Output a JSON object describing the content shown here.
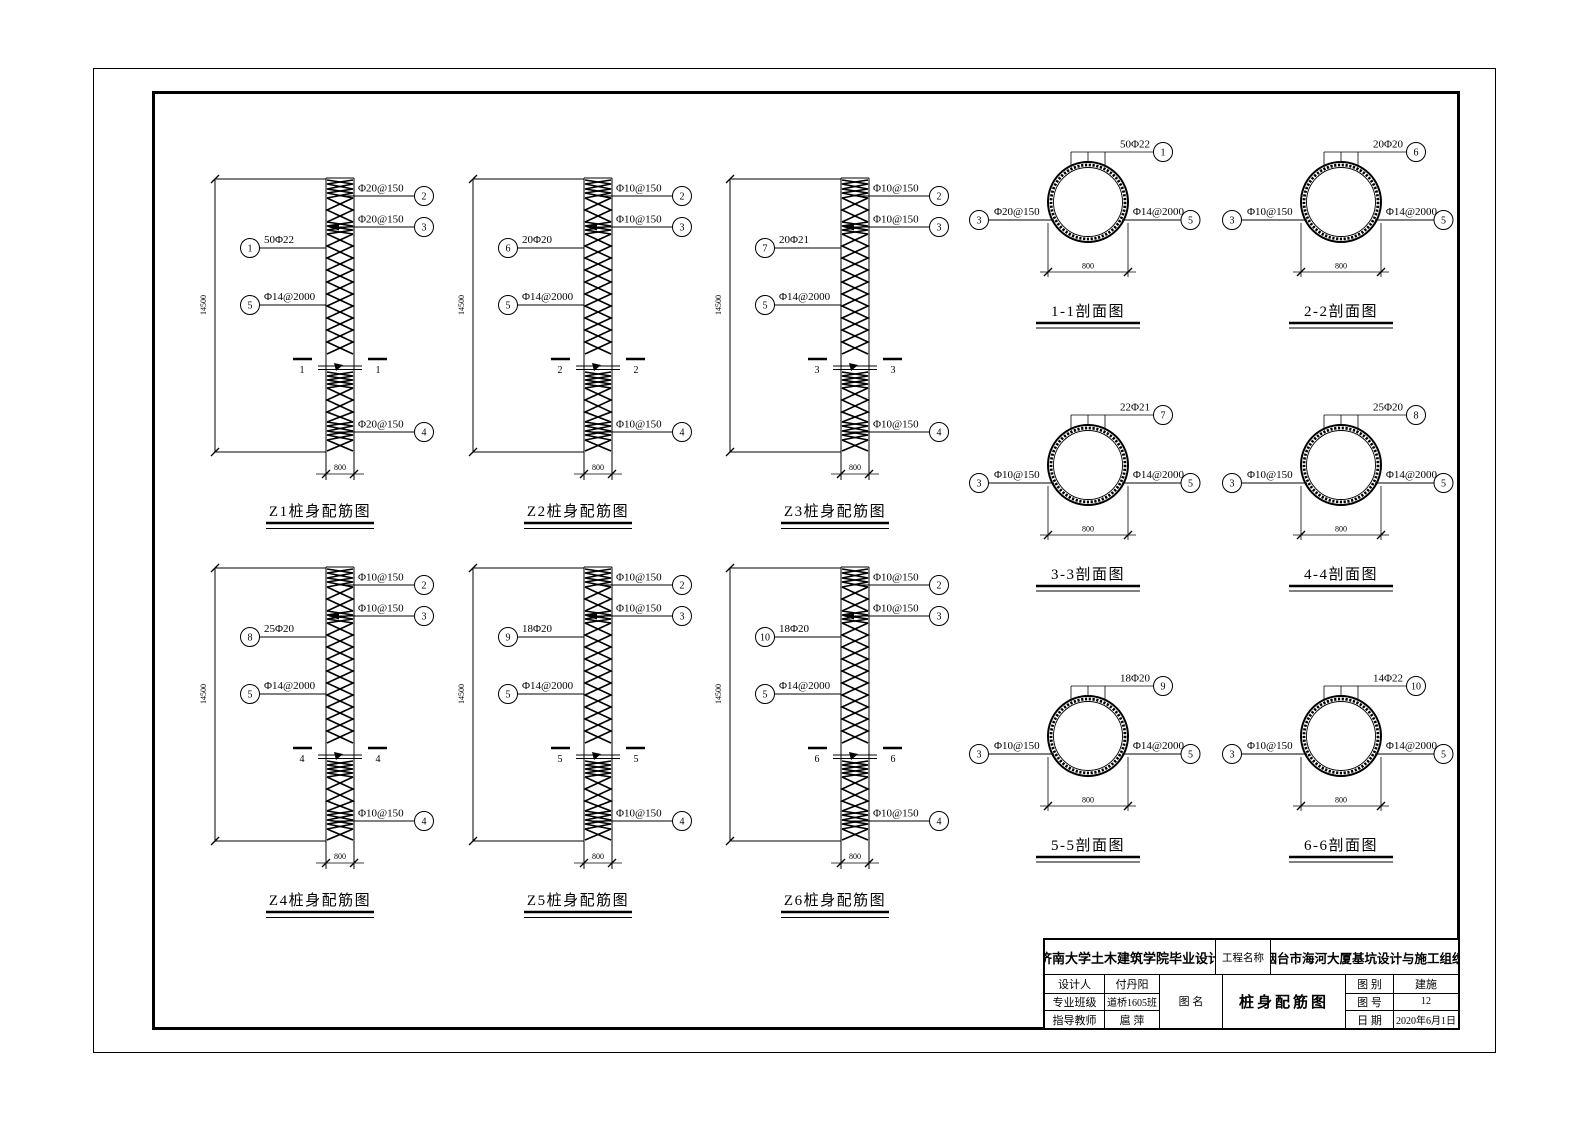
{
  "elevations": [
    {
      "id": "Z1",
      "title": "Z1桩身配筋图",
      "dim_height": "14500",
      "dim_width": "800",
      "cut_label": "1",
      "leaders": {
        "top1": {
          "ref": "2",
          "label": "Φ20@150"
        },
        "top2": {
          "ref": "3",
          "label": "Φ20@150"
        },
        "main": {
          "ref": "1",
          "label": "50Φ22"
        },
        "tie": {
          "ref": "5",
          "label": "Φ14@2000"
        },
        "bottom": {
          "ref": "4",
          "label": "Φ20@150"
        }
      }
    },
    {
      "id": "Z2",
      "title": "Z2桩身配筋图",
      "dim_height": "14500",
      "dim_width": "800",
      "cut_label": "2",
      "leaders": {
        "top1": {
          "ref": "2",
          "label": "Φ10@150"
        },
        "top2": {
          "ref": "3",
          "label": "Φ10@150"
        },
        "main": {
          "ref": "6",
          "label": "20Φ20"
        },
        "tie": {
          "ref": "5",
          "label": "Φ14@2000"
        },
        "bottom": {
          "ref": "4",
          "label": "Φ10@150"
        }
      }
    },
    {
      "id": "Z3",
      "title": "Z3桩身配筋图",
      "dim_height": "14500",
      "dim_width": "800",
      "cut_label": "3",
      "leaders": {
        "top1": {
          "ref": "2",
          "label": "Φ10@150"
        },
        "top2": {
          "ref": "3",
          "label": "Φ10@150"
        },
        "main": {
          "ref": "7",
          "label": "20Φ21"
        },
        "tie": {
          "ref": "5",
          "label": "Φ14@2000"
        },
        "bottom": {
          "ref": "4",
          "label": "Φ10@150"
        }
      }
    },
    {
      "id": "Z4",
      "title": "Z4桩身配筋图",
      "dim_height": "14500",
      "dim_width": "800",
      "cut_label": "4",
      "leaders": {
        "top1": {
          "ref": "2",
          "label": "Φ10@150"
        },
        "top2": {
          "ref": "3",
          "label": "Φ10@150"
        },
        "main": {
          "ref": "8",
          "label": "25Φ20"
        },
        "tie": {
          "ref": "5",
          "label": "Φ14@2000"
        },
        "bottom": {
          "ref": "4",
          "label": "Φ10@150"
        }
      }
    },
    {
      "id": "Z5",
      "title": "Z5桩身配筋图",
      "dim_height": "14500",
      "dim_width": "800",
      "cut_label": "5",
      "leaders": {
        "top1": {
          "ref": "2",
          "label": "Φ10@150"
        },
        "top2": {
          "ref": "3",
          "label": "Φ10@150"
        },
        "main": {
          "ref": "9",
          "label": "18Φ20"
        },
        "tie": {
          "ref": "5",
          "label": "Φ14@2000"
        },
        "bottom": {
          "ref": "4",
          "label": "Φ10@150"
        }
      }
    },
    {
      "id": "Z6",
      "title": "Z6桩身配筋图",
      "dim_height": "14500",
      "dim_width": "800",
      "cut_label": "6",
      "leaders": {
        "top1": {
          "ref": "2",
          "label": "Φ10@150"
        },
        "top2": {
          "ref": "3",
          "label": "Φ10@150"
        },
        "main": {
          "ref": "10",
          "label": "18Φ20"
        },
        "tie": {
          "ref": "5",
          "label": "Φ14@2000"
        },
        "bottom": {
          "ref": "4",
          "label": "Φ10@150"
        }
      }
    }
  ],
  "sections": [
    {
      "id": "1-1",
      "title": "1-1剖面图",
      "dim_width": "800",
      "top": {
        "ref": "1",
        "label": "50Φ22"
      },
      "left": {
        "ref": "3",
        "label": "Φ20@150"
      },
      "right": {
        "ref": "5",
        "label": "Φ14@2000"
      }
    },
    {
      "id": "2-2",
      "title": "2-2剖面图",
      "dim_width": "800",
      "top": {
        "ref": "6",
        "label": "20Φ20"
      },
      "left": {
        "ref": "3",
        "label": "Φ10@150"
      },
      "right": {
        "ref": "5",
        "label": "Φ14@2000"
      }
    },
    {
      "id": "3-3",
      "title": "3-3剖面图",
      "dim_width": "800",
      "top": {
        "ref": "7",
        "label": "22Φ21"
      },
      "left": {
        "ref": "3",
        "label": "Φ10@150"
      },
      "right": {
        "ref": "5",
        "label": "Φ14@2000"
      }
    },
    {
      "id": "4-4",
      "title": "4-4剖面图",
      "dim_width": "800",
      "top": {
        "ref": "8",
        "label": "25Φ20"
      },
      "left": {
        "ref": "3",
        "label": "Φ10@150"
      },
      "right": {
        "ref": "5",
        "label": "Φ14@2000"
      }
    },
    {
      "id": "5-5",
      "title": "5-5剖面图",
      "dim_width": "800",
      "top": {
        "ref": "9",
        "label": "18Φ20"
      },
      "left": {
        "ref": "3",
        "label": "Φ10@150"
      },
      "right": {
        "ref": "5",
        "label": "Φ14@2000"
      }
    },
    {
      "id": "6-6",
      "title": "6-6剖面图",
      "dim_width": "800",
      "top": {
        "ref": "10",
        "label": "14Φ22"
      },
      "left": {
        "ref": "3",
        "label": "Φ10@150"
      },
      "right": {
        "ref": "5",
        "label": "Φ14@2000"
      }
    }
  ],
  "title_block": {
    "university": "济南大学土木建筑学院毕业设计",
    "project_label": "工程名称",
    "project_name": "烟台市海河大厦基坑设计与施工组织",
    "designer_label": "设计人",
    "designer": "付丹阳",
    "class_label": "专业班级",
    "class_value": "道桥1605班",
    "advisor_label": "指导教师",
    "advisor": "扈 萍",
    "drawing_name_label": "图  名",
    "drawing_name": "桩身配筋图",
    "category_label": "图  别",
    "category": "建施",
    "number_label": "图  号",
    "number": "12",
    "date_label": "日  期",
    "date": "2020年6月1日"
  }
}
